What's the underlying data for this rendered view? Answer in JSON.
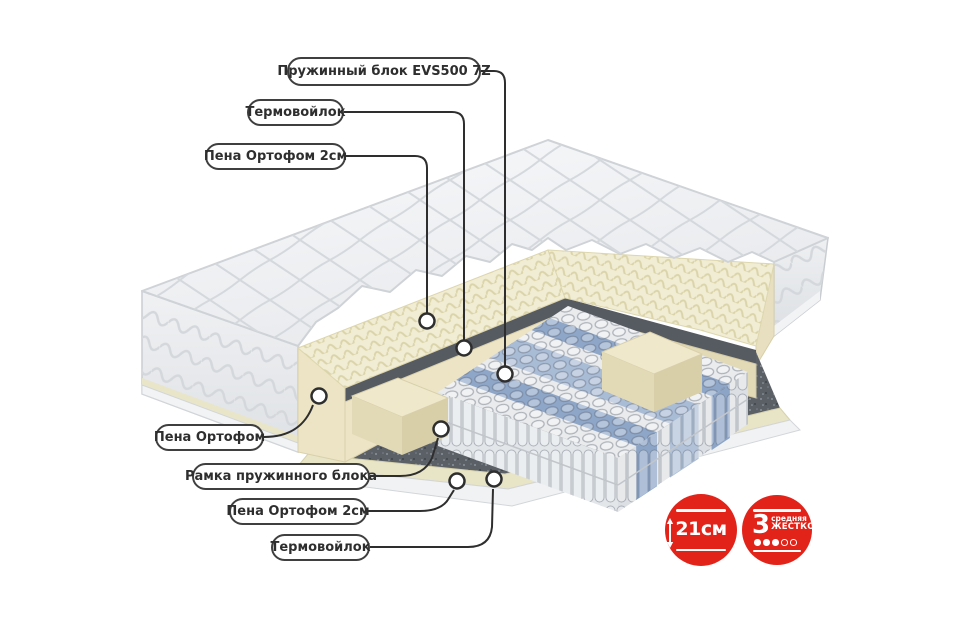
{
  "diagram_title": "Схема слоёв матраса (вид в разрезе)",
  "callouts": {
    "spring_block": "Пружинный блок EVS500 7Z",
    "thermofelt_top": "Термовойлок",
    "foam2_top": "Пена Ортофом 2см",
    "foam_side": "Пена Ортофом",
    "spring_frame": "Рамка пружинного блока",
    "foam2_bottom": "Пена Ортофом 2см",
    "thermofelt_bottom": "Термовойлок"
  },
  "badges": {
    "height": {
      "value": "21см"
    },
    "firmness": {
      "number": "3",
      "line1": "средняя",
      "line2": "жесткость",
      "filled_dots": 3,
      "total_dots": 5
    }
  },
  "colors": {
    "badge_red": "#e2231a",
    "quilt_white": "#f2f3f5",
    "foam_cream": "#efead0",
    "felt_gray": "#5b6067",
    "spring_blue": "#8ea6c8",
    "line_dark": "#2e2e2e"
  }
}
